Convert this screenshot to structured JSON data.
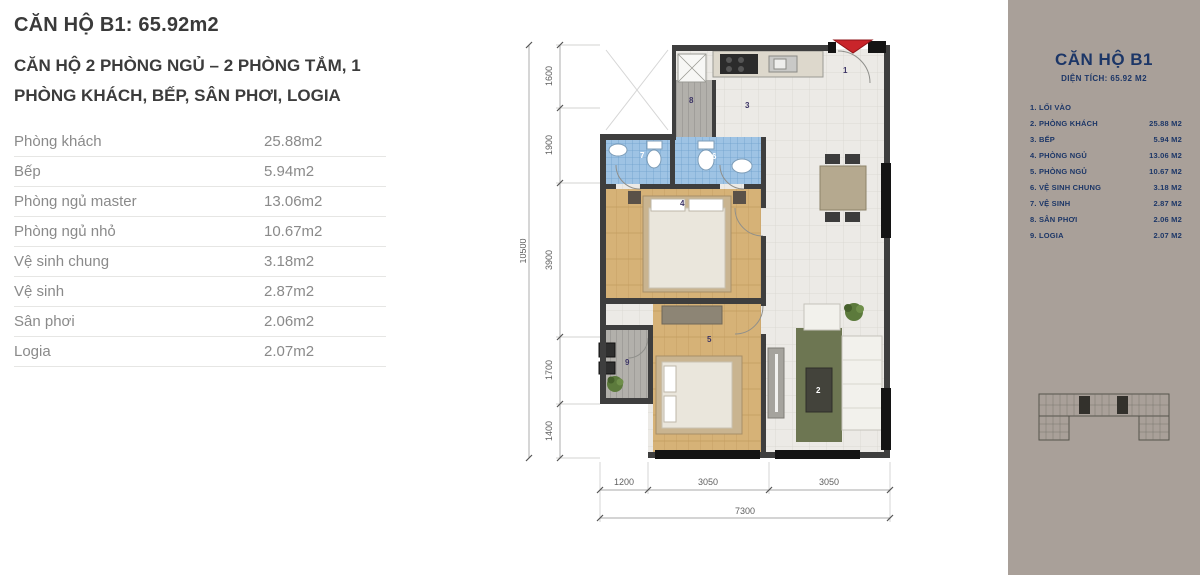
{
  "left_panel": {
    "title": "CĂN HỘ B1:  65.92m2",
    "subtitle": "CĂN HỘ 2 PHÒNG NGỦ – 2 PHÒNG TẮM, 1 PHÒNG KHÁCH, BẾP, SÂN PHƠI, LOGIA",
    "rooms": [
      {
        "label": "Phòng khách",
        "area": "25.88m2"
      },
      {
        "label": "Bếp",
        "area": "5.94m2"
      },
      {
        "label": "Phòng ngủ master",
        "area": "13.06m2"
      },
      {
        "label": "Phòng ngủ nhỏ",
        "area": "10.67m2"
      },
      {
        "label": "Vệ sinh chung",
        "area": "3.18m2"
      },
      {
        "label": "Vệ sinh",
        "area": "2.87m2"
      },
      {
        "label": "Sân phơi",
        "area": "2.06m2"
      },
      {
        "label": "Logia",
        "area": "2.07m2"
      }
    ]
  },
  "floor_plan": {
    "room_numbers": [
      "1",
      "2",
      "3",
      "4",
      "5",
      "6",
      "7",
      "8",
      "9"
    ],
    "dims_left": {
      "total": "10500",
      "segments": [
        "1600",
        "1900",
        "3900",
        "1700",
        "1400"
      ]
    },
    "dims_bottom": {
      "total": "7300",
      "segments": [
        "1200",
        "3050",
        "3050"
      ]
    }
  },
  "sidebar": {
    "title": "CĂN HỘ B1",
    "subtitle": "DIỆN TÍCH: 65.92 M2",
    "items": [
      {
        "num": "1.",
        "label": "LỐI VÀO",
        "area": ""
      },
      {
        "num": "2.",
        "label": "PHÒNG KHÁCH",
        "area": "25.88 M2"
      },
      {
        "num": "3.",
        "label": "BẾP",
        "area": "5.94 M2"
      },
      {
        "num": "4.",
        "label": "PHÒNG NGỦ",
        "area": "13.06 M2"
      },
      {
        "num": "5.",
        "label": "PHÒNG NGỦ",
        "area": "10.67 M2"
      },
      {
        "num": "6.",
        "label": "VỆ SINH CHUNG",
        "area": "3.18 M2"
      },
      {
        "num": "7.",
        "label": "VỆ SINH",
        "area": "2.87 M2"
      },
      {
        "num": "8.",
        "label": "SÂN PHƠI",
        "area": "2.06 M2"
      },
      {
        "num": "9.",
        "label": "LOGIA",
        "area": "2.07 M2"
      }
    ]
  },
  "colors": {
    "sidebar_bg": "#a9a099",
    "navy": "#1c3667",
    "entry_arrow_red": "#c9252b",
    "wall": "#3e3e3e",
    "wood_floor": "#d6b277",
    "bath_tile": "#9ec3e4"
  }
}
